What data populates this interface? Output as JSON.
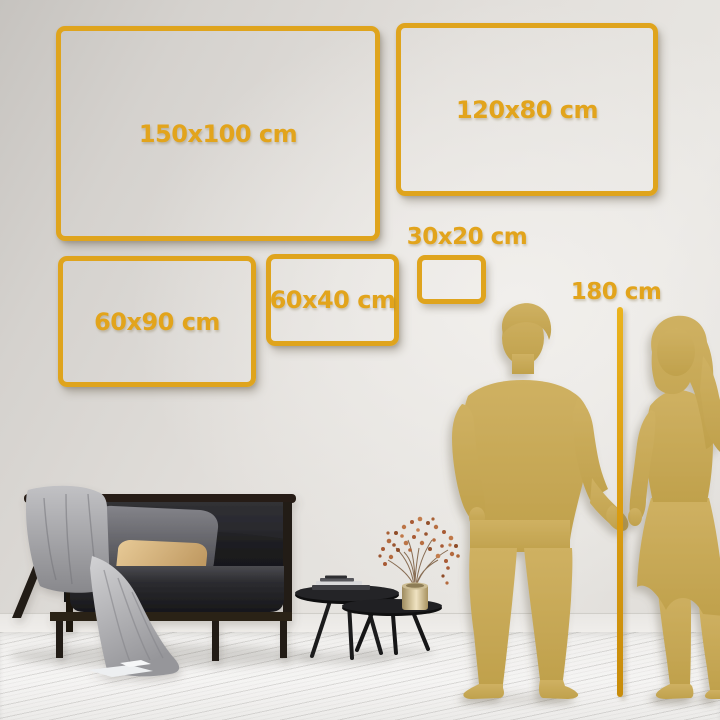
{
  "colors": {
    "accent_gold": "#dfa41d",
    "label_gold": "#e2a41c",
    "pole_gold": "#dc9e12",
    "silhouette_gold": "#c8a853",
    "wall": "#e2dfdb",
    "floor": "#f3f2f0"
  },
  "size_frames": [
    {
      "label": "150x100 cm"
    },
    {
      "label": "120x80 cm"
    },
    {
      "label": "60x90 cm"
    },
    {
      "label": "60x40 cm"
    },
    {
      "label": "30x20 cm"
    }
  ],
  "height_reference": {
    "label": "180 cm"
  },
  "icons": {
    "man": "man-silhouette",
    "woman": "woman-silhouette",
    "pole": "measuring-pole",
    "sofa": "sofa",
    "blanket": "throw-blanket",
    "pillows": "pillows",
    "coffee_tables": "coffee-tables",
    "plant": "vase-with-dried-plant"
  }
}
